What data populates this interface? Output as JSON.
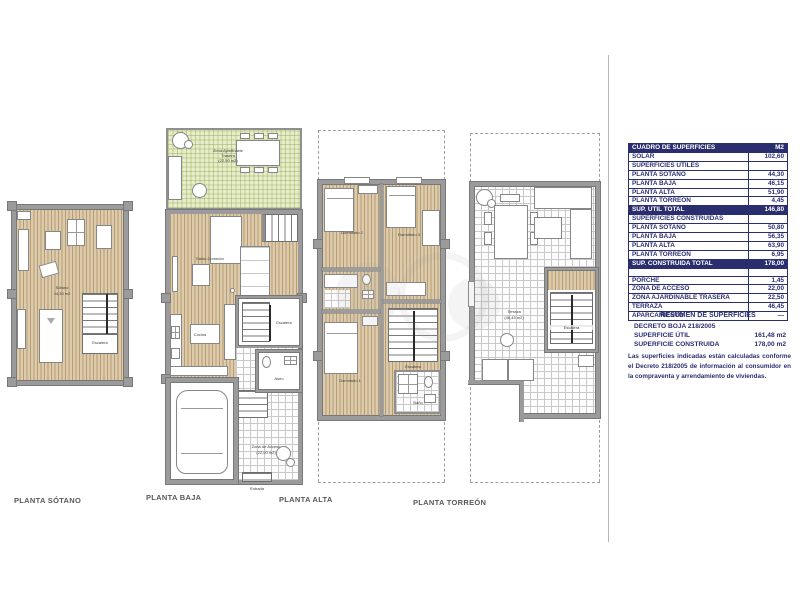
{
  "plans": {
    "sotano": {
      "title": "PLANTA SÓTANO",
      "room_label": "Sótano",
      "room_area": "44,30 m2",
      "stairs_label": "Escalera"
    },
    "baja": {
      "title": "PLANTA BAJA",
      "garden_label": "Zona Ajardinable",
      "garden_label2": "Trasera",
      "garden_area": "(22,50 m2)",
      "living_label": "Salón-Comedor",
      "kitchen_label": "Cocina",
      "stairs_label": "Escalera",
      "aseo_label": "Aseo",
      "access_label": "Zona de Acceso",
      "access_area": "(22,00 m2)",
      "entry_label": "Entrada"
    },
    "alta": {
      "title": "PLANTA ALTA",
      "bedroom1_label": "Dormitorio 1",
      "bedroom2_label": "Dormitorio 2",
      "bedroom3_label": "Dormitorio 3",
      "bath_label": "Baño",
      "stairs_label": "Escalera"
    },
    "torreon": {
      "title": "PLANTA TORREÓN",
      "terrace_label": "Terraza",
      "terrace_area": "(46,45 m2)",
      "stairs_label": "Escalera"
    }
  },
  "table": {
    "rows": [
      {
        "label": "CUADRO DE SUPERFICIES",
        "value": "M2",
        "emphasis": true
      },
      {
        "label": "SOLAR",
        "value": "102,60",
        "emphasis": false
      },
      {
        "label": "SUPERFICIES ÚTILES",
        "value": "",
        "emphasis": false
      },
      {
        "label": "PLANTA SÓTANO",
        "value": "44,30",
        "emphasis": false
      },
      {
        "label": "PLANTA BAJA",
        "value": "46,15",
        "emphasis": false
      },
      {
        "label": "PLANTA ALTA",
        "value": "51,90",
        "emphasis": false
      },
      {
        "label": "PLANTA TORREÓN",
        "value": "4,45",
        "emphasis": false
      },
      {
        "label": "SUP. ÚTIL TOTAL",
        "value": "146,80",
        "emphasis": true
      },
      {
        "label": "SUPERFICIES CONSTRUIDAS",
        "value": "",
        "emphasis": false
      },
      {
        "label": "PLANTA SÓTANO",
        "value": "50,80",
        "emphasis": false
      },
      {
        "label": "PLANTA BAJA",
        "value": "56,35",
        "emphasis": false
      },
      {
        "label": "PLANTA ALTA",
        "value": "63,90",
        "emphasis": false
      },
      {
        "label": "PLANTA TORREÓN",
        "value": "6,95",
        "emphasis": false
      },
      {
        "label": "SUP. CONSTRUIDA TOTAL",
        "value": "178,00",
        "emphasis": true
      },
      {
        "label": "",
        "value": "",
        "emphasis": false
      },
      {
        "label": "PORCHE",
        "value": "1,45",
        "emphasis": false
      },
      {
        "label": "ZONA DE ACCESO",
        "value": "22,00",
        "emphasis": false
      },
      {
        "label": "ZONA AJARDINABLE TRASERA",
        "value": "22,50",
        "emphasis": false
      },
      {
        "label": "TERRAZA",
        "value": "46,45",
        "emphasis": false
      },
      {
        "label": "APARCAMIENTO",
        "value": "—",
        "emphasis": false
      }
    ]
  },
  "summary": {
    "title": "RESUMEN DE SUPERFICIES",
    "decree": "DECRETO BOJA 218/2005",
    "lines": [
      {
        "label": "SUPERFICIE ÚTIL",
        "value": "161,48 m2"
      },
      {
        "label": "SUPERFICIE CONSTRUIDA",
        "value": "178,00 m2"
      }
    ],
    "note": "Las superficies indicadas están calculadas conforme el Decreto 218/2005 de información al consumidor en la compraventa y arrendamiento de viviendas."
  },
  "colors": {
    "navy": "#2b2e6e",
    "wall_gray": "#9b9b9b",
    "wood": "#ddccab",
    "garden_green": "#e6edc8"
  }
}
